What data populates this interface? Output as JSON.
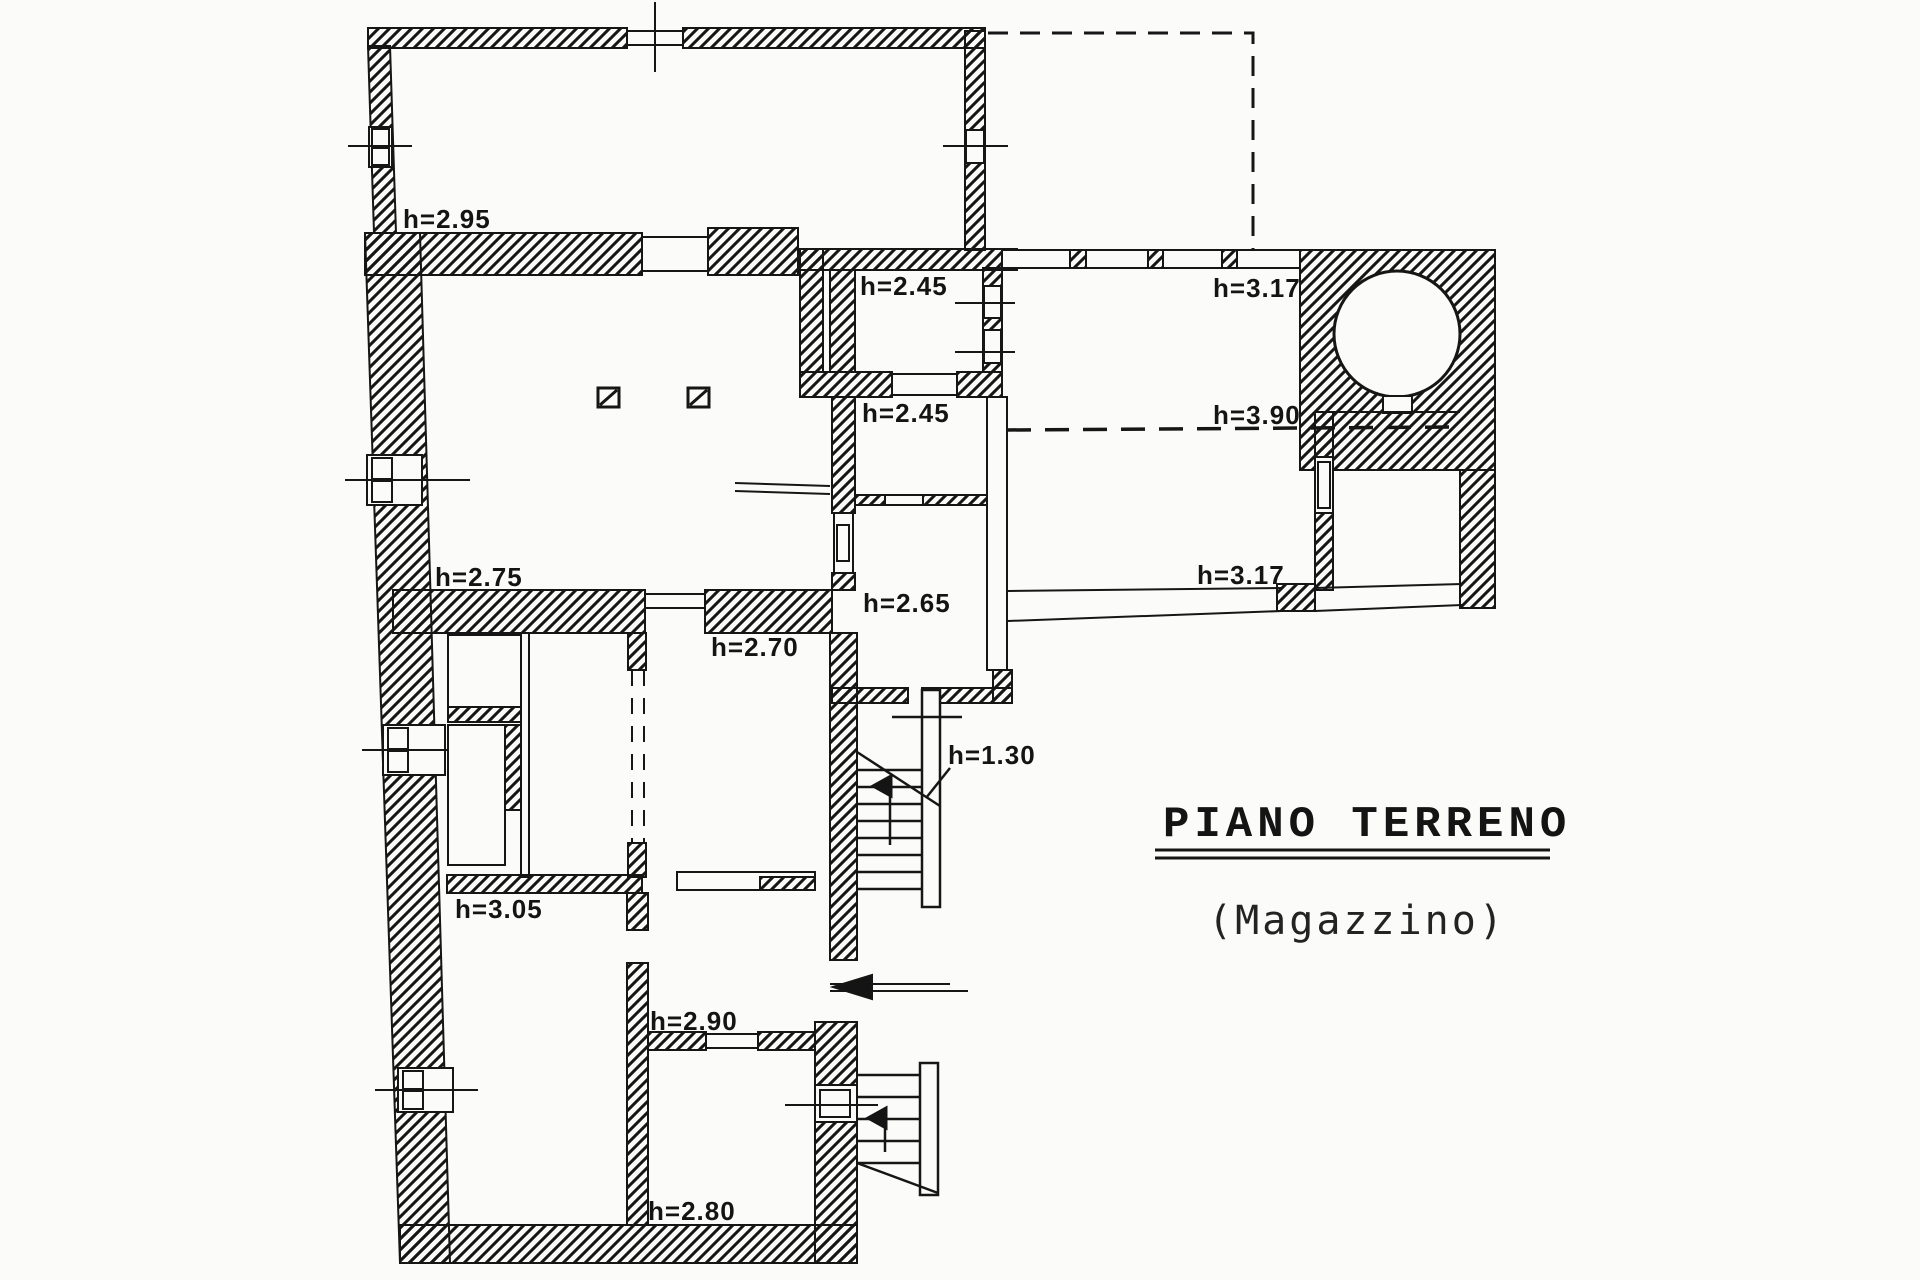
{
  "drawing": {
    "title": "PIANO TERRENO",
    "subtitle": "(Magazzino)",
    "ink_color": "#161616",
    "paper_color": "#fbfbf9"
  },
  "height_labels": [
    {
      "text": "h=2.95"
    },
    {
      "text": "h=2.45"
    },
    {
      "text": "h=3.17"
    },
    {
      "text": "h=2.45"
    },
    {
      "text": "h=3.90"
    },
    {
      "text": "h=2.75"
    },
    {
      "text": "h=3.17"
    },
    {
      "text": "h=2.65"
    },
    {
      "text": "h=2.70"
    },
    {
      "text": "h=1.30"
    },
    {
      "text": "h=3.05"
    },
    {
      "text": "h=2.90"
    },
    {
      "text": "h=2.80"
    }
  ]
}
